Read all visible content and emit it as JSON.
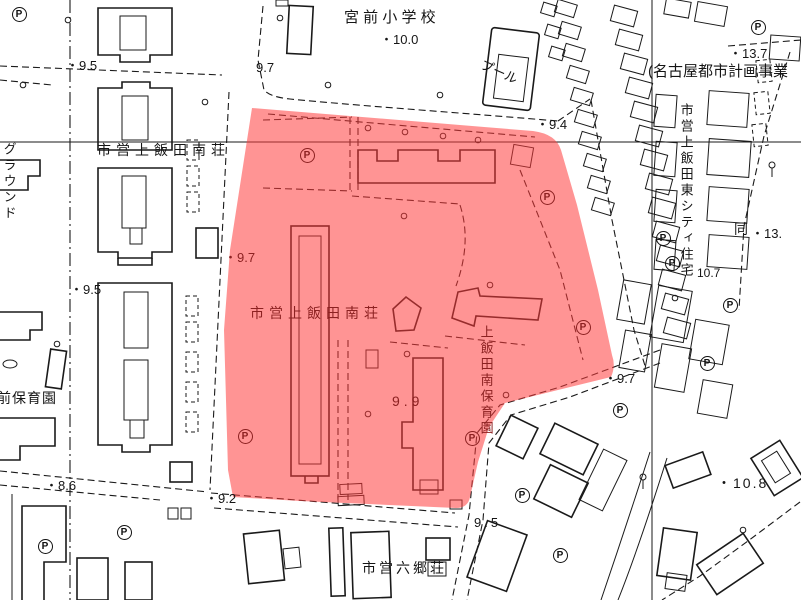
{
  "map": {
    "highlight_color": "rgba(255,60,60,0.55)",
    "parking_symbol": "P",
    "labels": [
      {
        "id": "school-name",
        "text": "宮 前 小 学 校",
        "x": 344,
        "y": 10,
        "size": 15
      },
      {
        "id": "elev-10-0",
        "text": "・10.0",
        "x": 380,
        "y": 33,
        "size": 13
      },
      {
        "id": "pool",
        "text": "プール",
        "x": 484,
        "y": 58,
        "size": 13,
        "rot": 24
      },
      {
        "id": "elev-9-7-school",
        "text": "9.7",
        "x": 256,
        "y": 61,
        "size": 13
      },
      {
        "id": "plan-title",
        "text": "(名古屋都市計画事業",
        "x": 648,
        "y": 64,
        "size": 15
      },
      {
        "id": "elev-13-7",
        "text": "・13.7",
        "x": 729,
        "y": 47,
        "size": 13
      },
      {
        "id": "elev-9-4",
        "text": "・9.4",
        "x": 536,
        "y": 118,
        "size": 13
      },
      {
        "id": "south-west-name",
        "text": "市営上飯田南荘",
        "x": 97,
        "y": 143,
        "size": 14,
        "spacing": 5
      },
      {
        "id": "ground",
        "text": "グラウンド",
        "x": 2,
        "y": 142,
        "size": 13,
        "vertical": true
      },
      {
        "id": "elev-9-5-top",
        "text": "・9.5",
        "x": 66,
        "y": 59,
        "size": 13
      },
      {
        "id": "elev-9-5-left",
        "text": "・9.5",
        "x": 70,
        "y": 283,
        "size": 13
      },
      {
        "id": "elev-9-7-red",
        "text": "・9.7",
        "x": 224,
        "y": 251,
        "size": 13,
        "in_red": true
      },
      {
        "id": "south-name",
        "text": "市営上飯田南荘",
        "x": 250,
        "y": 306,
        "size": 14,
        "spacing": 5,
        "in_red": true
      },
      {
        "id": "elev-9-9",
        "text": "9.9",
        "x": 392,
        "y": 394,
        "size": 14,
        "spacing": 4,
        "in_red": true
      },
      {
        "id": "nursery-south",
        "text": "上飯田南保育園",
        "x": 479,
        "y": 325,
        "size": 13,
        "vertical": true,
        "in_red": true
      },
      {
        "id": "elev-9-7-right",
        "text": "・9.7",
        "x": 604,
        "y": 372,
        "size": 13
      },
      {
        "id": "elev-9-5-bottom",
        "text": "9.5",
        "x": 474,
        "y": 516,
        "size": 13,
        "spacing": 3
      },
      {
        "id": "elev-9-2",
        "text": "・9.2",
        "x": 205,
        "y": 492,
        "size": 13
      },
      {
        "id": "elev-8-6",
        "text": "・8.6",
        "x": 45,
        "y": 479,
        "size": 13
      },
      {
        "id": "elev-10-8",
        "text": "・10.8",
        "x": 717,
        "y": 476,
        "size": 14,
        "spacing": 2
      },
      {
        "id": "elev-10-7",
        "text": "10.7",
        "x": 697,
        "y": 267,
        "size": 12
      },
      {
        "id": "elev-13-x",
        "text": "・13.",
        "x": 751,
        "y": 227,
        "size": 13
      },
      {
        "id": "rokugo-name",
        "text": "市営六郷荘",
        "x": 362,
        "y": 561,
        "size": 14,
        "spacing": 3
      },
      {
        "id": "nursery-mae",
        "text": "前保育園",
        "x": -3,
        "y": 391,
        "size": 14,
        "spacing": 1
      },
      {
        "id": "east-city-name",
        "text": "市営上飯田東シティ住宅",
        "x": 679,
        "y": 103,
        "size": 13,
        "vertical": true
      },
      {
        "id": "dou",
        "text": "同",
        "x": 734,
        "y": 222,
        "size": 14
      }
    ],
    "parking_marks": [
      {
        "x": 19,
        "y": 14
      },
      {
        "x": 45,
        "y": 546
      },
      {
        "x": 124,
        "y": 532
      },
      {
        "x": 522,
        "y": 495
      },
      {
        "x": 560,
        "y": 555
      },
      {
        "x": 620,
        "y": 410
      },
      {
        "x": 663,
        "y": 238
      },
      {
        "x": 672,
        "y": 263
      },
      {
        "x": 758,
        "y": 27
      },
      {
        "x": 730,
        "y": 305
      },
      {
        "x": 707,
        "y": 363
      },
      {
        "x": 307,
        "y": 155,
        "red": true
      },
      {
        "x": 547,
        "y": 197,
        "red": true
      },
      {
        "x": 583,
        "y": 327,
        "red": true
      },
      {
        "x": 245,
        "y": 436,
        "red": true
      },
      {
        "x": 472,
        "y": 438,
        "red": true
      }
    ]
  }
}
